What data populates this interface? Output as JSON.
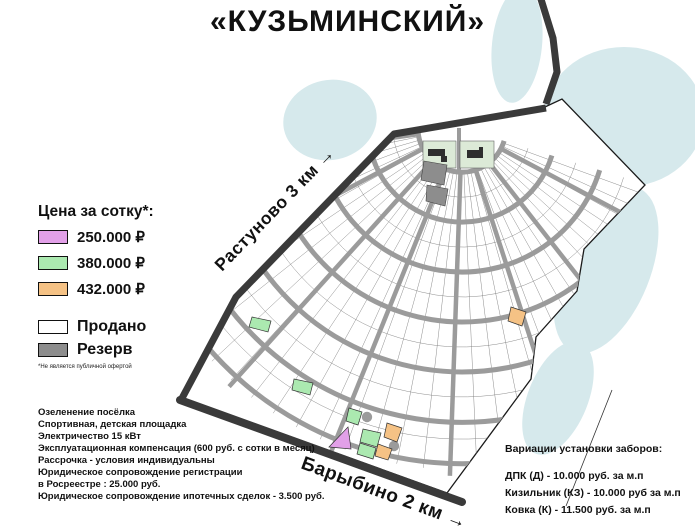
{
  "title": "«КУЗЬМИНСКИЙ»",
  "legend": {
    "heading": "Цена за сотку*:",
    "items": [
      {
        "color": "#e2a0e8",
        "label": "250.000 ₽"
      },
      {
        "color": "#abe9b0",
        "label": "380.000 ₽"
      },
      {
        "color": "#f5c285",
        "label": "432.000 ₽"
      }
    ],
    "status_items": [
      {
        "color": "#ffffff",
        "label": "Продано"
      },
      {
        "color": "#8d8d8d",
        "label": "Резерв"
      }
    ],
    "footnote": "*Не является публичной офертой"
  },
  "map": {
    "road_labels": [
      "Растуново 3 км →",
      "Барыбино 2 км →"
    ]
  },
  "amenities": {
    "lines": [
      "Озеленение посёлка",
      "Спортивная, детская площадка",
      "Электричество 15 кВт",
      "Эксплуатационная компенсация (600 руб. с сотки в месяц)",
      "Рассрочка - условия индивидуальны",
      "Юридическое сопровождение регистрации",
      "в Росреестре : 25.000 руб.",
      "Юридическое сопровождение ипотечных сделок - 3.500 руб."
    ]
  },
  "fences": {
    "heading": "Вариации установки заборов:",
    "lines": [
      "ДПК (Д) - 10.000 руб. за м.п",
      "Кизильник (КЗ) - 10.000 руб за м.п",
      "Ковка (К) - 11.500 руб. за м.п"
    ]
  },
  "colors": {
    "water": "#d6e9ec",
    "road_dark": "#3a3a3a",
    "road_gray": "#9b9b9b",
    "hairline": "#7f7f7f",
    "reserve": "#8d8d8d",
    "entrance_green": "#dcead7"
  }
}
